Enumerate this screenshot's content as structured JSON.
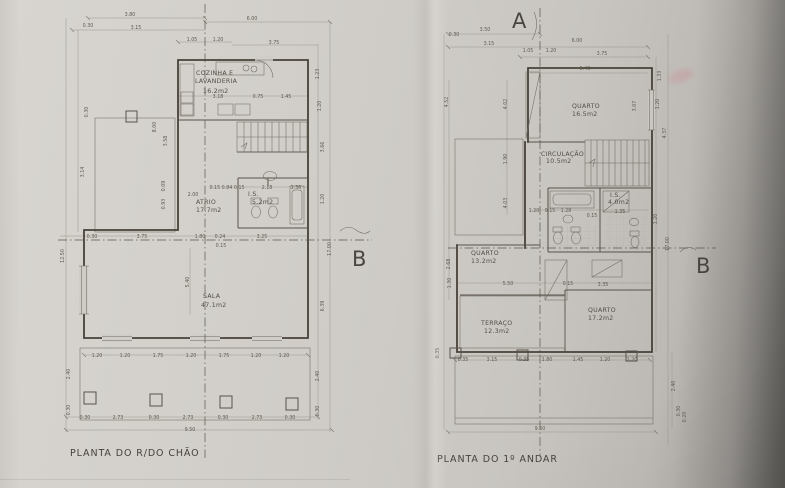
{
  "document": {
    "type_note": "photographed architectural floor plan sheets",
    "paper_color": "#cdcac5",
    "line_color": "#55504a"
  },
  "section_markers": {
    "a": "A",
    "b_left": "B",
    "b_right": "B"
  },
  "left_plan": {
    "title": "PLANTA DO R/DO CHÃO",
    "rooms": [
      {
        "x": 196,
        "y": 75,
        "t": "COZINHA E"
      },
      {
        "x": 195,
        "y": 83,
        "t": "LAVANDERIA"
      },
      {
        "x": 203,
        "y": 93,
        "t": "16.2m2"
      },
      {
        "x": 196,
        "y": 204,
        "t": "ATRIO"
      },
      {
        "x": 196,
        "y": 212,
        "t": "17.7m2"
      },
      {
        "x": 248,
        "y": 196,
        "t": "I.S."
      },
      {
        "x": 252,
        "y": 204,
        "t": "5.2m2"
      },
      {
        "x": 203,
        "y": 298,
        "t": "SALA"
      },
      {
        "x": 201,
        "y": 307,
        "t": "47.1m2"
      }
    ],
    "dims": [
      {
        "x": 130,
        "y": 16,
        "t": "3.80"
      },
      {
        "x": 88,
        "y": 27,
        "t": "0.30"
      },
      {
        "x": 136,
        "y": 29,
        "t": "3.15"
      },
      {
        "x": 252,
        "y": 20,
        "t": "6.00"
      },
      {
        "x": 192,
        "y": 41,
        "t": "1.05"
      },
      {
        "x": 218,
        "y": 41,
        "t": "1.20"
      },
      {
        "x": 274,
        "y": 44,
        "t": "3.75"
      },
      {
        "x": 218,
        "y": 98,
        "t": "3.18"
      },
      {
        "x": 258,
        "y": 98,
        "t": "0.75"
      },
      {
        "x": 286,
        "y": 98,
        "t": "1.45"
      },
      {
        "x": 193,
        "y": 196,
        "t": "2.00"
      },
      {
        "x": 227,
        "y": 189,
        "t": "0.15 0.84 0.15"
      },
      {
        "x": 267,
        "y": 189,
        "t": "2.18"
      },
      {
        "x": 296,
        "y": 189,
        "t": "1.36"
      },
      {
        "x": 92,
        "y": 238,
        "t": "0.30"
      },
      {
        "x": 142,
        "y": 238,
        "t": "3.75"
      },
      {
        "x": 200,
        "y": 238,
        "t": "1.80"
      },
      {
        "x": 220,
        "y": 238,
        "t": "0.24"
      },
      {
        "x": 262,
        "y": 238,
        "t": "3.25"
      },
      {
        "x": 221,
        "y": 247,
        "t": "0.15"
      },
      {
        "x": 189,
        "y": 282,
        "t": "5.40",
        "r": -90
      },
      {
        "x": 97,
        "y": 357,
        "t": "1.20"
      },
      {
        "x": 125,
        "y": 357,
        "t": "1.20"
      },
      {
        "x": 158,
        "y": 357,
        "t": "1.75"
      },
      {
        "x": 191,
        "y": 357,
        "t": "1.20"
      },
      {
        "x": 224,
        "y": 357,
        "t": "1.75"
      },
      {
        "x": 256,
        "y": 357,
        "t": "1.20"
      },
      {
        "x": 284,
        "y": 357,
        "t": "1.20"
      },
      {
        "x": 85,
        "y": 419,
        "t": "0.30"
      },
      {
        "x": 118,
        "y": 419,
        "t": "2.73"
      },
      {
        "x": 154,
        "y": 419,
        "t": "0.30"
      },
      {
        "x": 188,
        "y": 419,
        "t": "2.73"
      },
      {
        "x": 223,
        "y": 419,
        "t": "0.30"
      },
      {
        "x": 257,
        "y": 419,
        "t": "2.73"
      },
      {
        "x": 290,
        "y": 419,
        "t": "0.30"
      },
      {
        "x": 190,
        "y": 431,
        "t": "9.50"
      },
      {
        "x": 64,
        "y": 256,
        "t": "12.50",
        "r": -90
      },
      {
        "x": 88,
        "y": 112,
        "t": "0.30",
        "r": -90
      },
      {
        "x": 84,
        "y": 172,
        "t": "3.14",
        "r": -90
      },
      {
        "x": 156,
        "y": 127,
        "t": "8.00",
        "r": -90
      },
      {
        "x": 167,
        "y": 141,
        "t": "3.58",
        "r": -90
      },
      {
        "x": 165,
        "y": 186,
        "t": "0.09",
        "r": -90
      },
      {
        "x": 165,
        "y": 204,
        "t": "0.93",
        "r": -90
      },
      {
        "x": 70,
        "y": 374,
        "t": "2.40",
        "r": -90
      },
      {
        "x": 70,
        "y": 410,
        "t": "0.30",
        "r": -90
      },
      {
        "x": 319,
        "y": 74,
        "t": "1.23",
        "r": -90
      },
      {
        "x": 321,
        "y": 106,
        "t": "1.20",
        "r": -90
      },
      {
        "x": 324,
        "y": 147,
        "t": "3.66",
        "r": -90
      },
      {
        "x": 324,
        "y": 199,
        "t": "1.20",
        "r": -90
      },
      {
        "x": 331,
        "y": 249,
        "t": "17.00",
        "r": -90
      },
      {
        "x": 324,
        "y": 306,
        "t": "6.39",
        "r": -90
      },
      {
        "x": 319,
        "y": 376,
        "t": "2.40",
        "r": -90
      },
      {
        "x": 319,
        "y": 411,
        "t": "0.30",
        "r": -90
      }
    ]
  },
  "right_plan": {
    "title": "PLANTA DO 1º ANDAR",
    "rooms": [
      {
        "x": 572,
        "y": 108,
        "t": "QUARTO"
      },
      {
        "x": 572,
        "y": 116,
        "t": "16.5m2"
      },
      {
        "x": 541,
        "y": 156,
        "t": "CIRCULAÇÃO"
      },
      {
        "x": 546,
        "y": 163,
        "t": "10.5m2"
      },
      {
        "x": 610,
        "y": 197,
        "t": "I.S."
      },
      {
        "x": 608,
        "y": 204,
        "t": "4.0m2"
      },
      {
        "x": 471,
        "y": 255,
        "t": "QUARTO"
      },
      {
        "x": 471,
        "y": 263,
        "t": "13.2m2"
      },
      {
        "x": 481,
        "y": 325,
        "t": "TERRAÇO"
      },
      {
        "x": 484,
        "y": 333,
        "t": "12.3m2"
      },
      {
        "x": 588,
        "y": 312,
        "t": "QUARTO"
      },
      {
        "x": 588,
        "y": 320,
        "t": "17.2m2"
      }
    ],
    "dims": [
      {
        "x": 485,
        "y": 31,
        "t": "3.50"
      },
      {
        "x": 454,
        "y": 36,
        "t": "0.30"
      },
      {
        "x": 489,
        "y": 45,
        "t": "3.15"
      },
      {
        "x": 577,
        "y": 42,
        "t": "6.00"
      },
      {
        "x": 528,
        "y": 52,
        "t": "1.05"
      },
      {
        "x": 551,
        "y": 52,
        "t": "1.20"
      },
      {
        "x": 602,
        "y": 55,
        "t": "3.75"
      },
      {
        "x": 585,
        "y": 70,
        "t": "5.40"
      },
      {
        "x": 661,
        "y": 76,
        "t": "1.33",
        "r": -90
      },
      {
        "x": 659,
        "y": 104,
        "t": "1.20",
        "r": -90
      },
      {
        "x": 636,
        "y": 106,
        "t": "3.07",
        "r": -90
      },
      {
        "x": 666,
        "y": 133,
        "t": "4.37",
        "r": -90
      },
      {
        "x": 657,
        "y": 219,
        "t": "1.20",
        "r": -90
      },
      {
        "x": 669,
        "y": 244,
        "t": "17.00",
        "r": -90
      },
      {
        "x": 675,
        "y": 386,
        "t": "2.40",
        "r": -90
      },
      {
        "x": 680,
        "y": 411,
        "t": "0.30",
        "r": -90
      },
      {
        "x": 686,
        "y": 417,
        "t": "0.20",
        "r": -90
      },
      {
        "x": 448,
        "y": 102,
        "t": "4.52",
        "r": -90
      },
      {
        "x": 507,
        "y": 104,
        "t": "4.02",
        "r": -90
      },
      {
        "x": 507,
        "y": 159,
        "t": "1.90",
        "r": -90
      },
      {
        "x": 507,
        "y": 203,
        "t": "4.03",
        "r": -90
      },
      {
        "x": 450,
        "y": 264,
        "t": "2.68",
        "r": -90
      },
      {
        "x": 451,
        "y": 283,
        "t": "1.30",
        "r": -90
      },
      {
        "x": 439,
        "y": 353,
        "t": "0.35",
        "r": -90
      },
      {
        "x": 534,
        "y": 212,
        "t": "1.20"
      },
      {
        "x": 550,
        "y": 212,
        "t": "0.15"
      },
      {
        "x": 566,
        "y": 212,
        "t": "1.28"
      },
      {
        "x": 592,
        "y": 217,
        "t": "0.15"
      },
      {
        "x": 620,
        "y": 213,
        "t": "1.35"
      },
      {
        "x": 508,
        "y": 285,
        "t": "5.50"
      },
      {
        "x": 568,
        "y": 285,
        "t": "0.15"
      },
      {
        "x": 603,
        "y": 286,
        "t": "3.35"
      },
      {
        "x": 463,
        "y": 361,
        "t": "0.35"
      },
      {
        "x": 492,
        "y": 361,
        "t": "3.15"
      },
      {
        "x": 524,
        "y": 361,
        "t": "0.35"
      },
      {
        "x": 547,
        "y": 361,
        "t": "1.80"
      },
      {
        "x": 578,
        "y": 361,
        "t": "1.45"
      },
      {
        "x": 605,
        "y": 361,
        "t": "1.20"
      },
      {
        "x": 632,
        "y": 361,
        "t": "1.20"
      },
      {
        "x": 540,
        "y": 430,
        "t": "9.50"
      }
    ]
  }
}
